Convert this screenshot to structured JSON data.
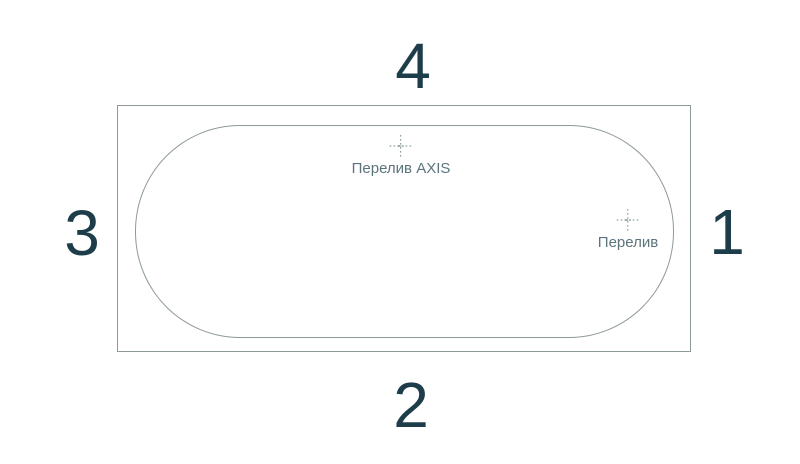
{
  "diagram": {
    "sides": {
      "top": "4",
      "right": "1",
      "bottom": "2",
      "left": "3"
    },
    "markers": {
      "overflow_axis": {
        "label": "Перелив AXIS"
      },
      "overflow": {
        "label": "Перелив"
      }
    },
    "colors": {
      "outline": "#8e9a99",
      "number": "#1e3d4a",
      "label_text": "#5b747d",
      "marker": "#8fa0a0",
      "background": "#ffffff"
    }
  }
}
